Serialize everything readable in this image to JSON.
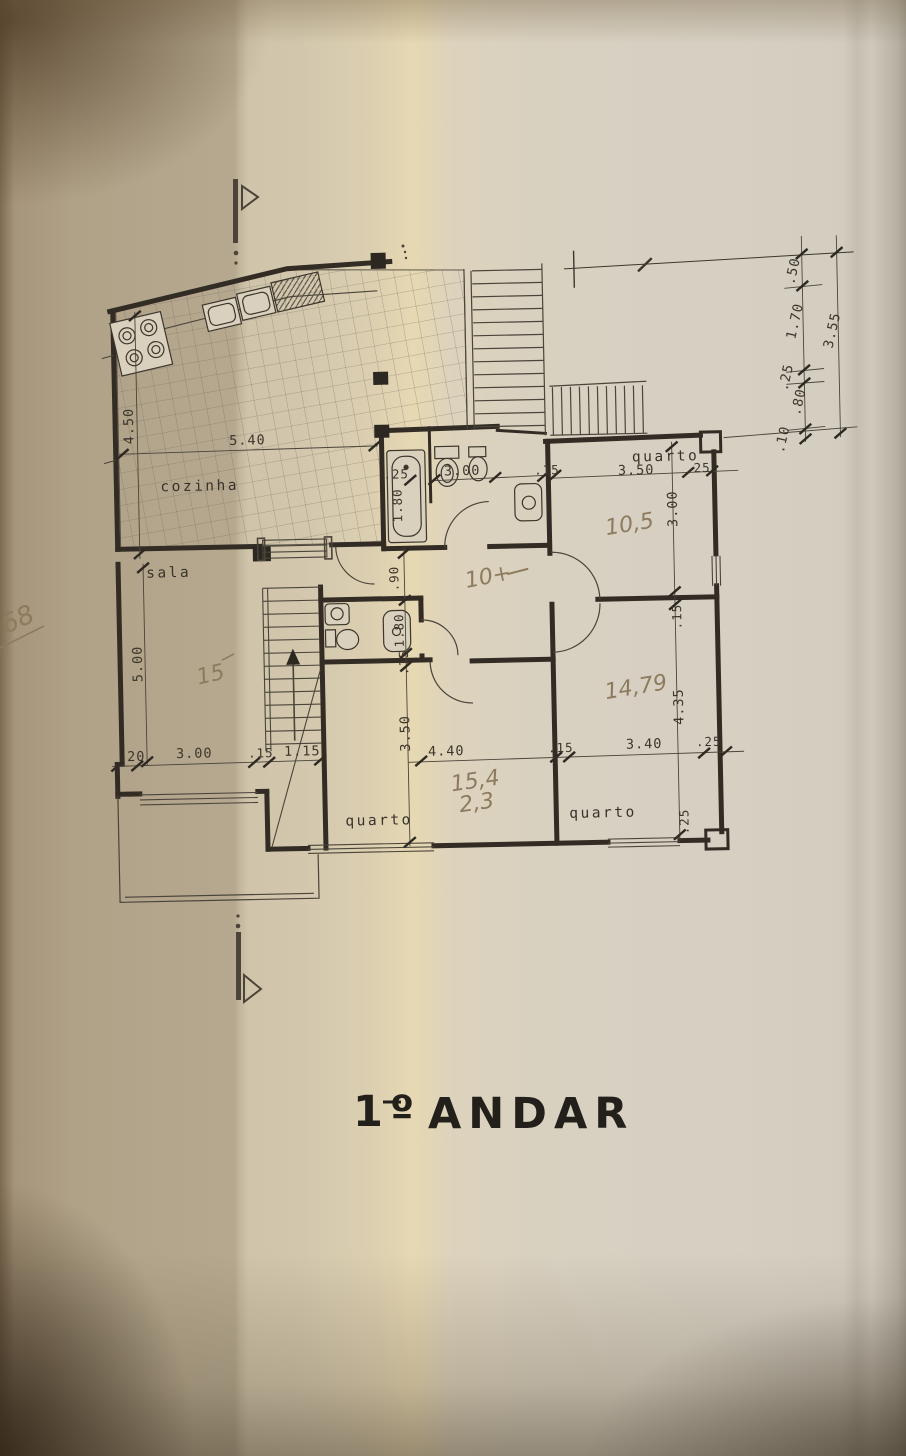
{
  "drawing": {
    "title_prefix": "1º",
    "title_main": "ANDAR",
    "room_labels": {
      "kitchen": "cozinha",
      "living_room": "sala",
      "bedroom_top": "quarto",
      "bedroom_left": "quarto",
      "bedroom_right": "quarto"
    },
    "printed_dimensions": {
      "kitchen_depth": "4.50",
      "kitchen_width": "5.40",
      "bath_recess": ".25",
      "bath_tub": "1.80",
      "bath_width": "3.00",
      "bath_wall": ".15",
      "bedroom_top_width": "3.50",
      "bedroom_top_wall_right": ".25",
      "bedroom_top_depth": "3.00",
      "bedroom_top_wall_bottom": ".15",
      "hall_width": ".90",
      "wc_length": "1.80",
      "wc_wall": ".15",
      "living_depth": "5.00",
      "chain_left": [
        ".20",
        "3.00",
        ".15",
        "1.15"
      ],
      "bedroom_left_depth": "3.50",
      "bedroom_left_width": "4.40",
      "chain_right": [
        ".15",
        "3.40",
        ".25"
      ],
      "bedroom_right_depth": "4.35",
      "bedroom_right_wall_bottom": ".25",
      "side_chain": {
        "segments": [
          ".50",
          "1.70",
          ".25",
          ".80",
          ".10"
        ],
        "total": "3.55"
      }
    },
    "handwritten_notes": {
      "living_room": "15",
      "hall": "10+",
      "bedroom_top": "10,5",
      "bedroom_right": "14,79",
      "bedroom_left_line1": "15,4",
      "bedroom_left_line2": "2,3",
      "margin_note": "68"
    }
  }
}
